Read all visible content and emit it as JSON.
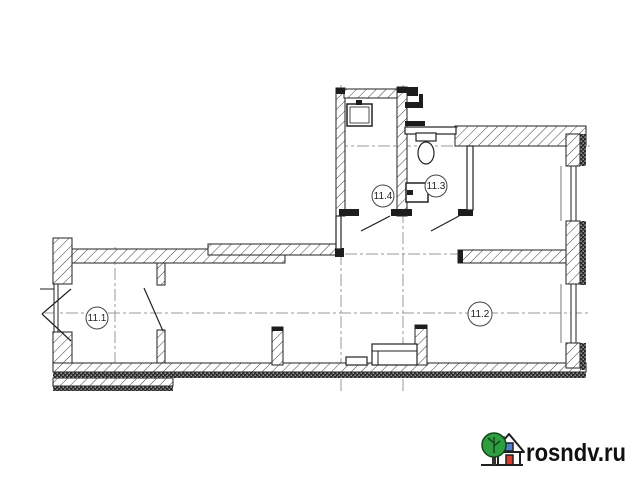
{
  "plan": {
    "room_labels": [
      {
        "label": "11.1"
      },
      {
        "label": "11.2"
      },
      {
        "label": "11.3"
      },
      {
        "label": "11.4"
      }
    ],
    "fixture_icons": [
      "sink-icon",
      "toilet-icon",
      "washbasin-icon"
    ],
    "colors": {
      "wall_line": "#222222",
      "hatch_line": "#3f3f3f",
      "centerline": "#999999"
    }
  },
  "watermark": {
    "label": "rosndv.ru",
    "icon": "house-with-tree-icon",
    "colors": {
      "tree": "#2f9e41",
      "window": "#4d7fd0",
      "door": "#d93a2b",
      "outline": "#1f1f1f"
    }
  }
}
